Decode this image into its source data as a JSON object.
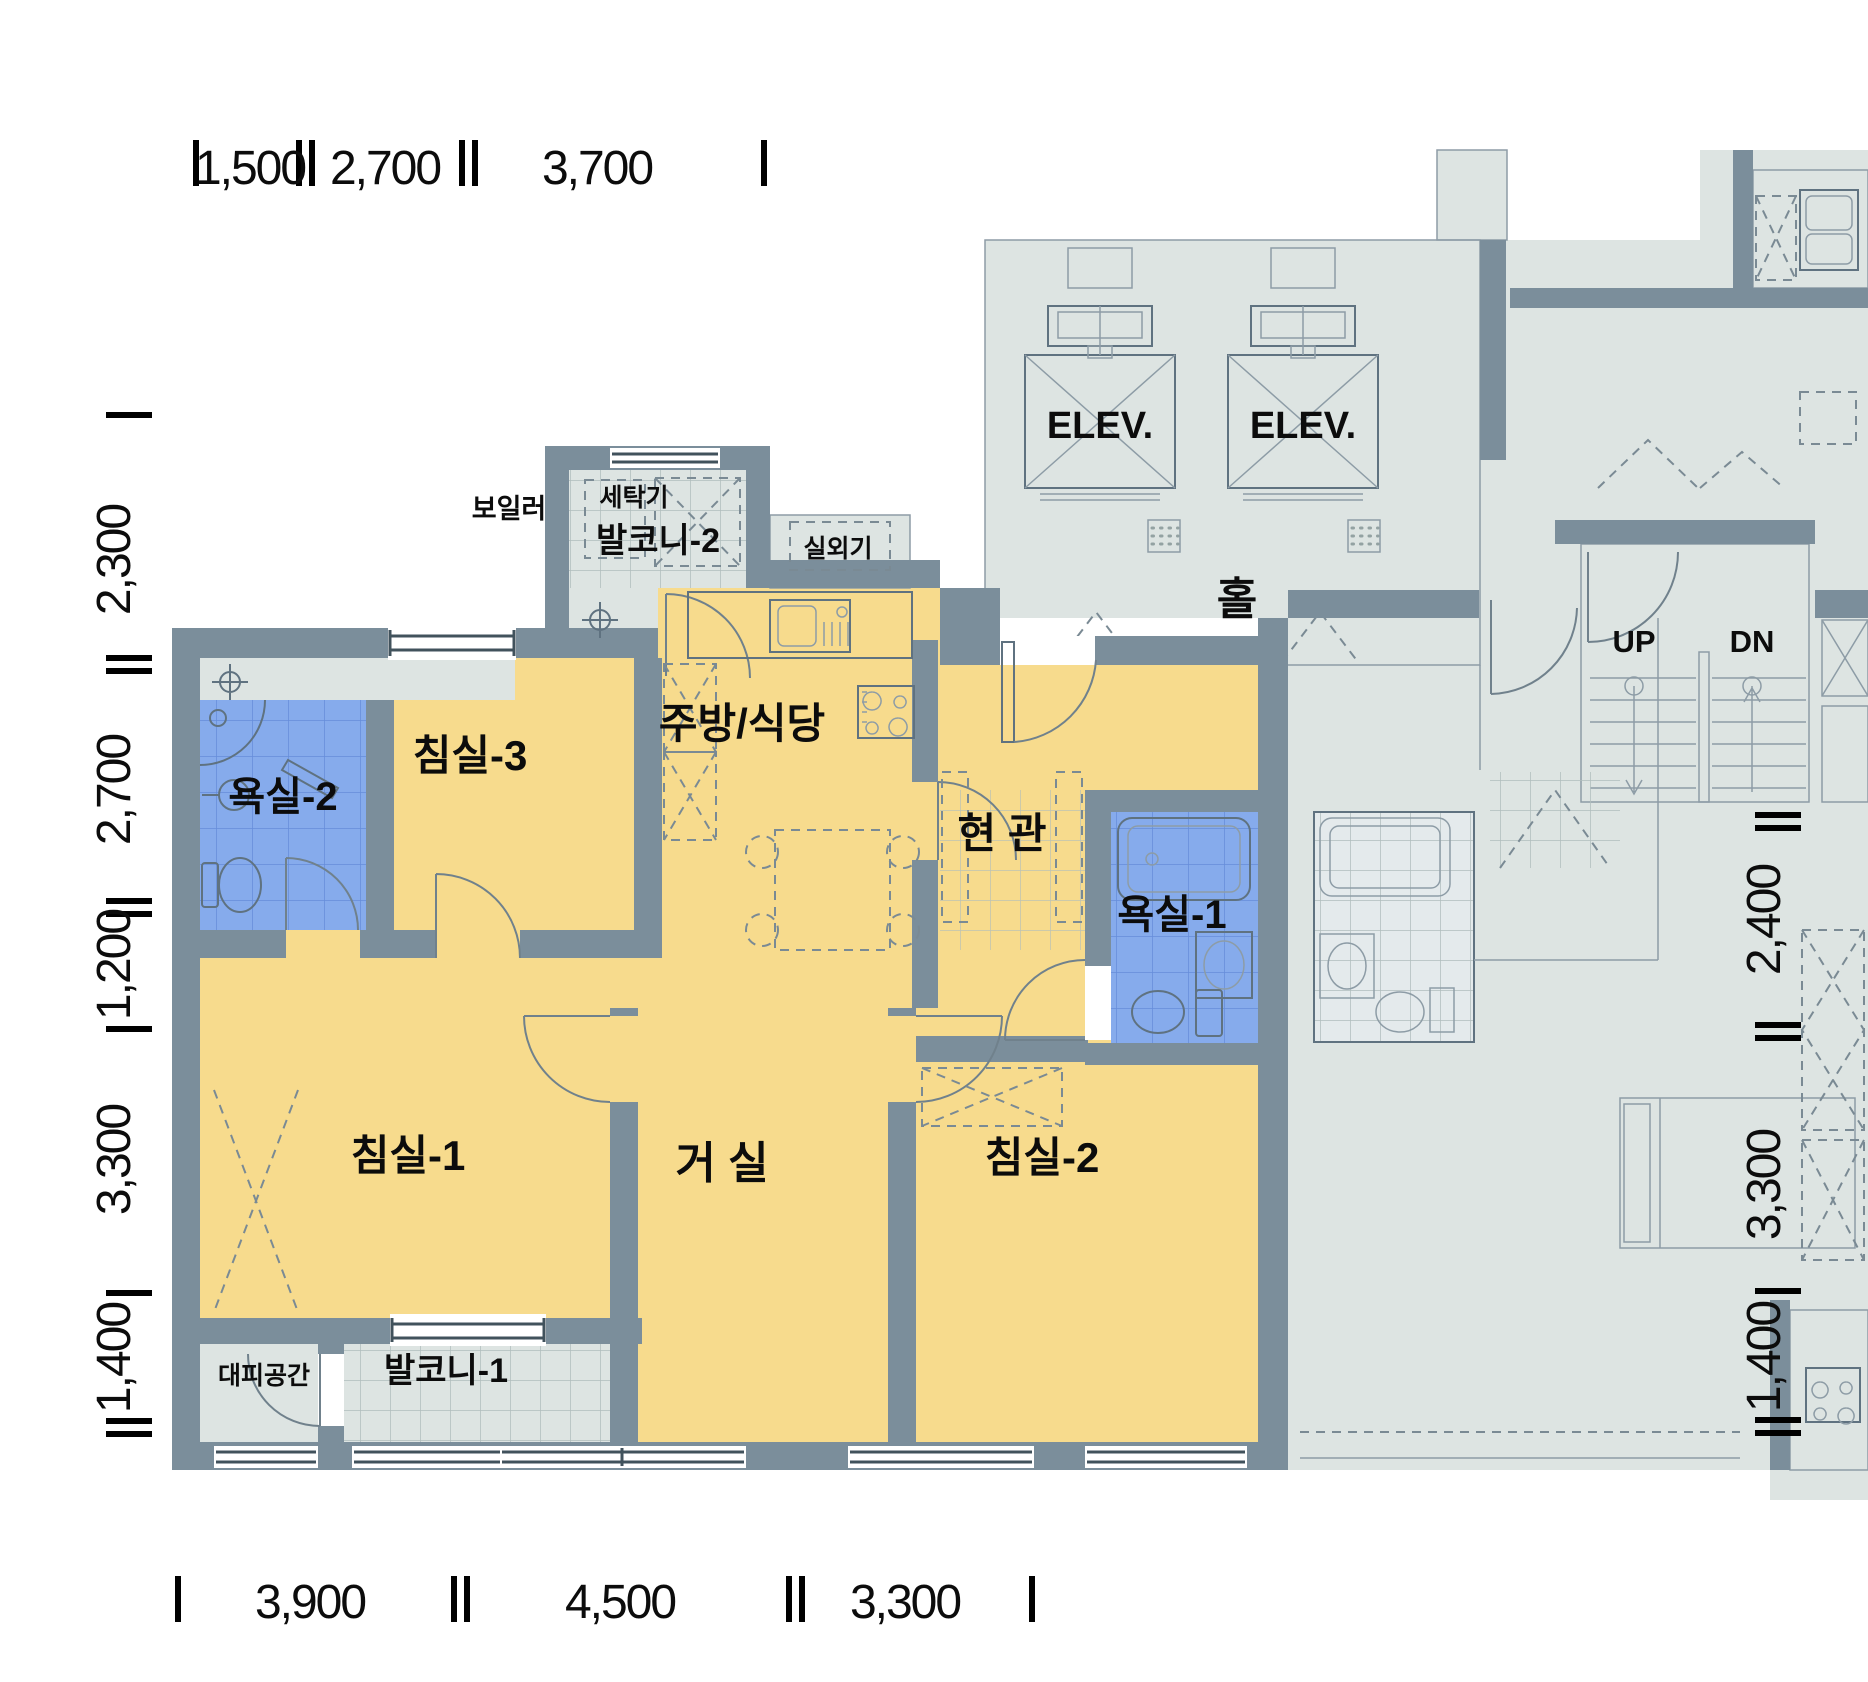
{
  "dimensions": {
    "top": [
      "1,500",
      "2,700",
      "3,700"
    ],
    "bottom": [
      "3,900",
      "4,500",
      "3,300"
    ],
    "left": [
      "2,300",
      "2,700",
      "1,200",
      "3,300",
      "1,400"
    ],
    "right": [
      "2,400",
      "3,300",
      "1,400"
    ]
  },
  "rooms": {
    "bedroom1": "침실-1",
    "bedroom2": "침실-2",
    "bedroom3": "침실-3",
    "living_room": "거 실",
    "kitchen_dining": "주방/식당",
    "entrance": "현 관",
    "bathroom1": "욕실-1",
    "bathroom2": "욕실-2",
    "balcony1": "발코니-1",
    "balcony2": "발코니-2",
    "evacuation_space": "대피공간",
    "washer": "세탁기",
    "boiler": "보일러",
    "outdoor_unit": "실외기"
  },
  "common_area": {
    "hall": "홀",
    "elevator1": "ELEV.",
    "elevator2": "ELEV.",
    "stairs_up": "UP",
    "stairs_down": "DN"
  },
  "colors": {
    "wall": "#7b8e9b",
    "room_fill": "#f7db8d",
    "wet_area_fill": "#86abec",
    "common_fill": "#dde4e2",
    "text": "#0c0c0c"
  }
}
